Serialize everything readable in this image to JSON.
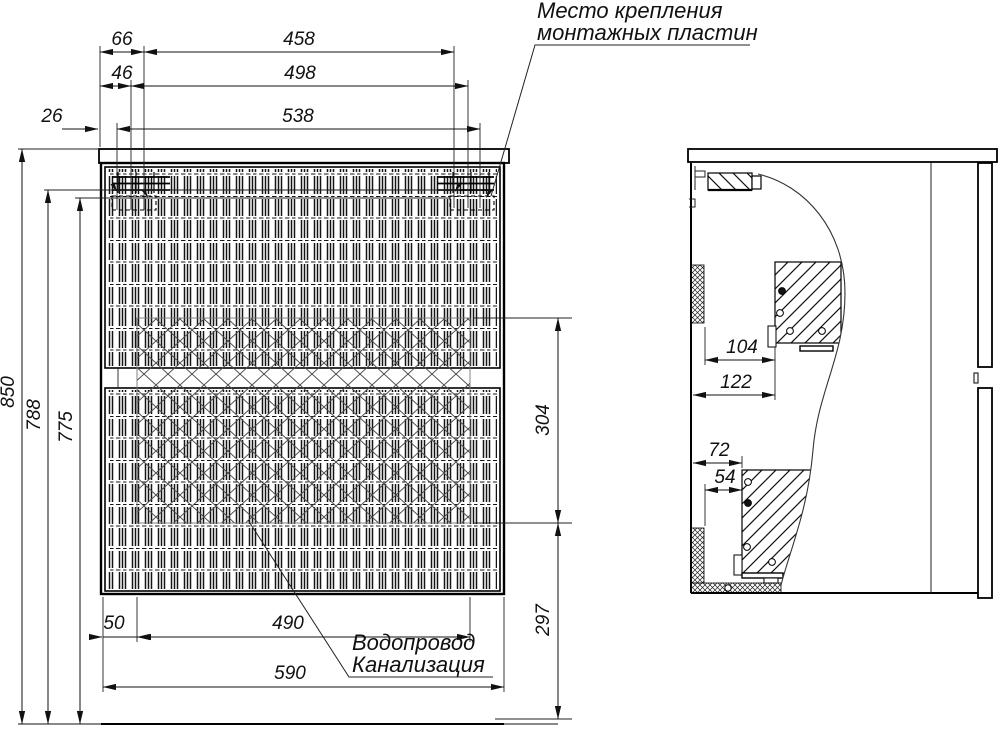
{
  "annotations": {
    "mounting_plates": {
      "line1": "Место крепления",
      "line2": "монтажных пластин"
    },
    "plumbing": {
      "line1": "Водопровод",
      "line2": "Канализация"
    }
  },
  "dimensions": {
    "front_top": {
      "d66": "66",
      "d458": "458",
      "d46": "46",
      "d498": "498",
      "d26": "26",
      "d538": "538"
    },
    "front_left": {
      "d850": "850",
      "d788": "788",
      "d775": "775"
    },
    "front_right": {
      "d304": "304",
      "d297": "297"
    },
    "front_bottom": {
      "d50": "50",
      "d490": "490",
      "d590": "590"
    },
    "side": {
      "d104": "104",
      "d122": "122",
      "d72": "72",
      "d54": "54"
    }
  }
}
